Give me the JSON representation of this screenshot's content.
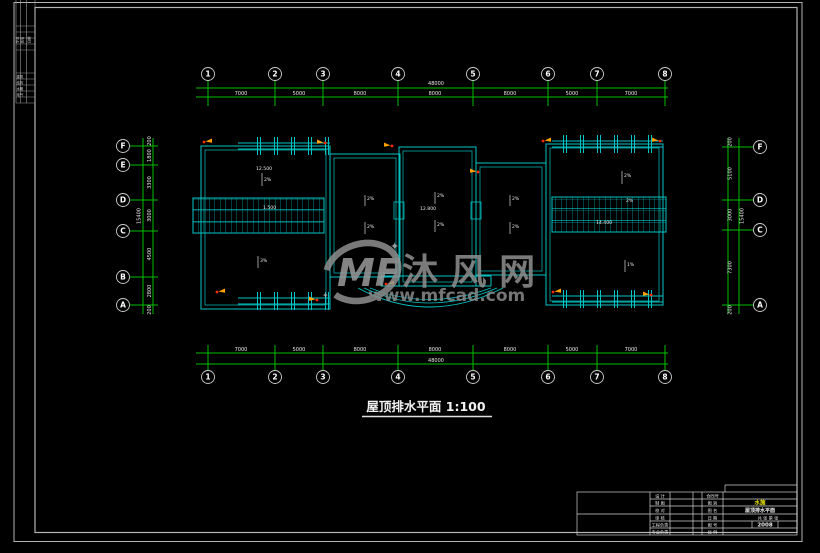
{
  "colors": {
    "background": "#000000",
    "frame": "#c8c8c8",
    "grid_lines": "#00c000",
    "building_lines": "#00c4c4",
    "text": "#ffffff",
    "drain_marker": "#ffa000",
    "drain_dot": "#ff2a00",
    "watermark": "#909090",
    "phase_yellow": "#e8e400"
  },
  "corner_stamp": {
    "headers": [
      "专业",
      "姓名",
      "日期"
    ],
    "rows": [
      "建筑",
      "结构",
      "水暖",
      "电气"
    ]
  },
  "grid": {
    "top_axes": [
      "1",
      "2",
      "3",
      "4",
      "5",
      "6",
      "7",
      "8"
    ],
    "bottom_axes": [
      "1",
      "2",
      "3",
      "4",
      "5",
      "6",
      "7",
      "8"
    ],
    "left_axes": [
      "F",
      "E",
      "D",
      "C",
      "B",
      "A"
    ],
    "right_axes": [
      "F",
      "D",
      "C",
      "A"
    ],
    "top_dims": [
      "7000",
      "5000",
      "8000",
      "8000",
      "8000",
      "5000",
      "7000"
    ],
    "top_total": "48000",
    "bottom_dims": [
      "7000",
      "5000",
      "8000",
      "8000",
      "8000",
      "5000",
      "7000"
    ],
    "bottom_total": "48000",
    "left_dims": [
      "1800",
      "3300",
      "3000",
      "4500",
      "2800"
    ],
    "left_total": "15400",
    "left_end_top": "200",
    "left_end_bottom": "200",
    "right_dims": [
      "5100",
      "3000",
      "7300"
    ],
    "right_total": "15400",
    "right_end_top": "200",
    "right_end_bottom": "200"
  },
  "plan": {
    "labels": [
      {
        "t": "12.500"
      },
      {
        "t": "2%"
      },
      {
        "t": "1.500"
      },
      {
        "t": "3%"
      },
      {
        "t": "2%"
      },
      {
        "t": "2%"
      },
      {
        "t": "2%"
      },
      {
        "t": "12.800"
      },
      {
        "t": "2%"
      },
      {
        "t": "2%"
      },
      {
        "t": "2%"
      },
      {
        "t": "2%"
      },
      {
        "t": "2%"
      },
      {
        "t": "14.400"
      },
      {
        "t": "1%"
      }
    ]
  },
  "watermark": {
    "logo": "MF",
    "name": "沐 风 网",
    "url": "www.mfcad.com"
  },
  "title": {
    "text": "屋顶排水平面 1:100"
  },
  "titleblock": {
    "left_labels": [
      "设 计",
      "制 图",
      "校 对",
      "审 核",
      "工程负责",
      "专业负责"
    ],
    "right_labels": [
      "合同号",
      "图 别",
      "图 名",
      "日 期",
      "图 号",
      "比 例"
    ],
    "values": {
      "category": "水施",
      "drawing_name": "屋顶排水平面",
      "sheets": "共 张 第 张",
      "number": "2008"
    }
  }
}
